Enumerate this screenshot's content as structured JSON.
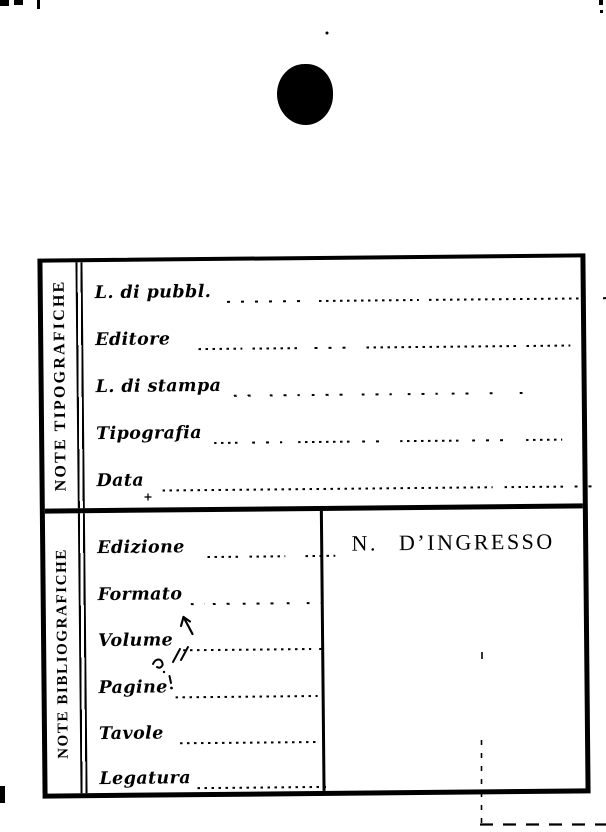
{
  "colors": {
    "ink": "#000000",
    "paper": "#ffffff"
  },
  "card": {
    "sections": [
      {
        "side_label": "NOTE TIPOGRAFICHE",
        "fields": [
          {
            "label": "L. di pubbl."
          },
          {
            "label": "Editore"
          },
          {
            "label": "L. di stampa"
          },
          {
            "label": "Tipografia"
          },
          {
            "label": "Data"
          }
        ]
      },
      {
        "side_label": "NOTE BIBLIOGRAFICHE",
        "fields": [
          {
            "label": "Edizione"
          },
          {
            "label": "Formato"
          },
          {
            "label": "Volume"
          },
          {
            "label": "Pagine"
          },
          {
            "label": "Tavole"
          },
          {
            "label": "Legatura"
          }
        ],
        "ingresso_panel": {
          "title": "N. D’INGRESSO"
        }
      }
    ]
  }
}
